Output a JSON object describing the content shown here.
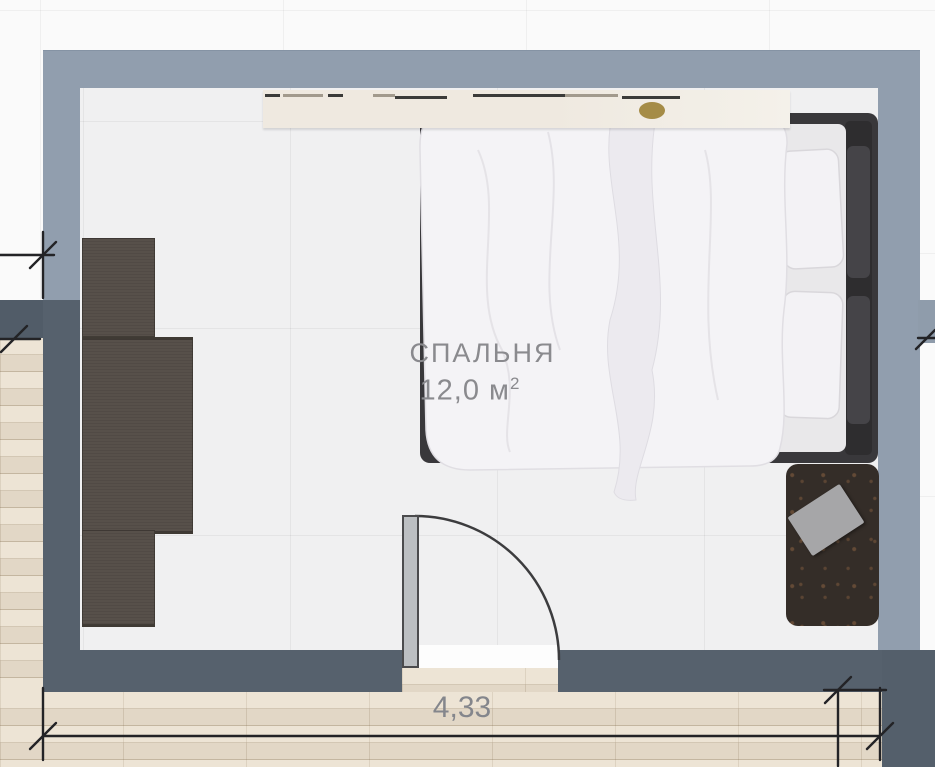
{
  "room": {
    "name": "СПАЛЬНЯ",
    "area_label": "12,0 м",
    "area_sup": "2"
  },
  "dimension": {
    "bottom_width": "4,33"
  },
  "palette": {
    "wall_light": "#919eae",
    "wall_dark": "#56616d",
    "interior_floor": "#f0f0f1",
    "wood_floor": "#eadfcd",
    "wardrobe": "#57504a",
    "bed_frame": "#39383b",
    "bedding": "#f4f3f6",
    "rug": "#342d28",
    "gold_accent": "#a58c47",
    "label_text": "#8a8a8e"
  }
}
